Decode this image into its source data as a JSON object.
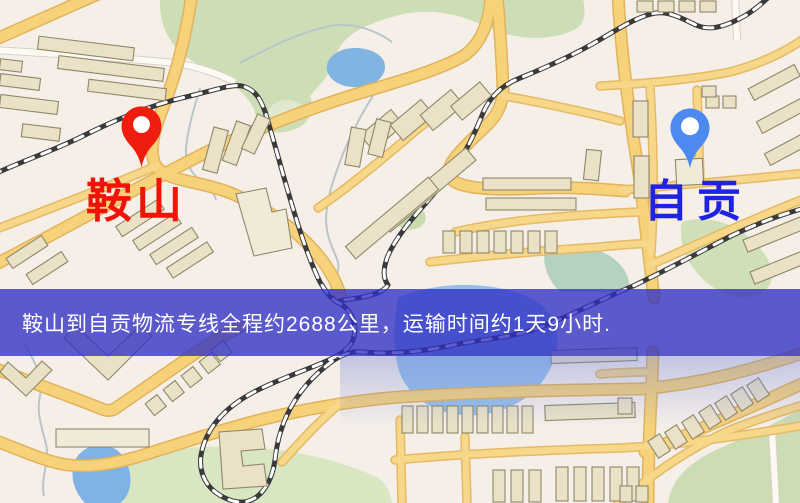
{
  "map": {
    "origin": {
      "name": "鞍山",
      "label_color": "#ef1407",
      "pin_color": "#ee1d0e"
    },
    "destination": {
      "name": "自贡",
      "label_color": "#1d23e0",
      "pin_color": "#4c89f0"
    },
    "info_banner": {
      "text": "鞍山到自贡物流专线全程约2688公里，运输时间约1天9小时.",
      "distance": "2688公里",
      "duration": "1天9小时",
      "background_color": "#4b4ecb",
      "text_color": "#ffffff"
    }
  }
}
